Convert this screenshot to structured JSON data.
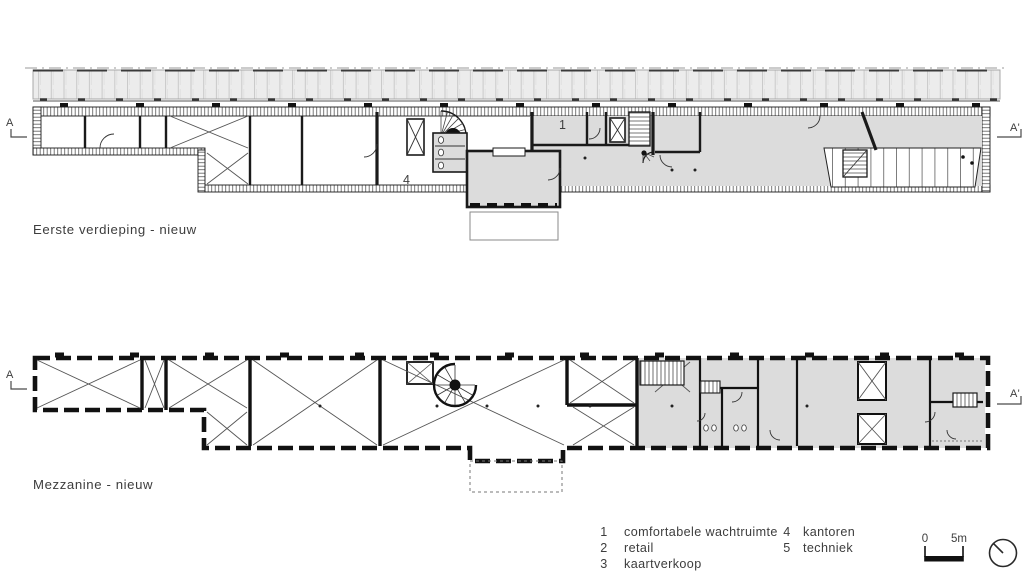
{
  "plans": {
    "first_floor": {
      "title": "Eerste verdieping - nieuw",
      "section_marker_left": "A",
      "section_marker_right": "A'",
      "room_numbers": {
        "kantoren": "4",
        "wachtruimte": "1"
      }
    },
    "mezzanine": {
      "title": "Mezzanine - nieuw",
      "section_marker_left": "A",
      "section_marker_right": "A'"
    }
  },
  "legend": {
    "items": [
      {
        "num": "1",
        "label": "comfortabele wachtruimte"
      },
      {
        "num": "2",
        "label": "retail"
      },
      {
        "num": "3",
        "label": "kaartverkoop"
      },
      {
        "num": "4",
        "label": "kantoren"
      },
      {
        "num": "5",
        "label": "techniek"
      }
    ]
  },
  "scale_bar": {
    "zero": "0",
    "five": "5m"
  },
  "icons": {
    "north_indicator": "north-arrow-circle"
  },
  "colors": {
    "room_fill": "#dcdcdc",
    "canopy_fill": "#ececec",
    "line": "#1a1a1a",
    "text": "#3d3d3d"
  }
}
